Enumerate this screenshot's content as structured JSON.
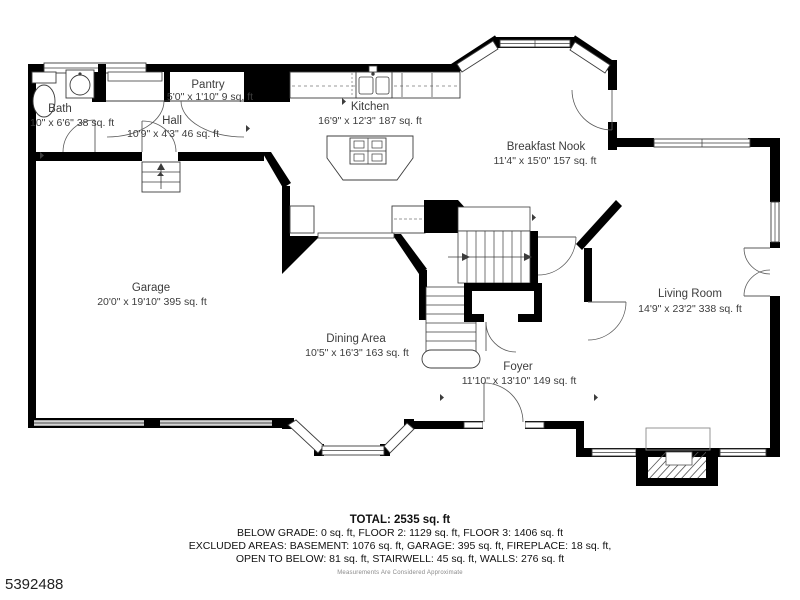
{
  "plan": {
    "rooms": {
      "bath": {
        "name": "Bath",
        "dims": "10\" x 6'6\" 38 sq. ft"
      },
      "pantry": {
        "name": "Pantry",
        "dims": "5'0\" x 1'10\" 9 sq. ft"
      },
      "hall": {
        "name": "Hall",
        "dims": "10'9\" x 4'3\" 46 sq. ft"
      },
      "kitchen": {
        "name": "Kitchen",
        "dims": "16'9\" x 12'3\" 187 sq. ft"
      },
      "breakfast_nook": {
        "name": "Breakfast Nook",
        "dims": "11'4\" x 15'0\" 157 sq. ft"
      },
      "garage": {
        "name": "Garage",
        "dims": "20'0\" x 19'10\" 395 sq. ft"
      },
      "dining": {
        "name": "Dining Area",
        "dims": "10'5\" x 16'3\" 163 sq. ft"
      },
      "foyer": {
        "name": "Foyer",
        "dims": "11'10\" x 13'10\" 149 sq. ft"
      },
      "living": {
        "name": "Living Room",
        "dims": "14'9\" x 23'2\" 338 sq. ft"
      }
    }
  },
  "summary": {
    "total": "TOTAL: 2535 sq. ft",
    "line2": "BELOW GRADE: 0 sq. ft, FLOOR 2: 1129 sq. ft, FLOOR 3: 1406 sq. ft",
    "line3": "EXCLUDED AREAS: BASEMENT: 1076 sq. ft, GARAGE: 395 sq. ft, FIREPLACE: 18 sq. ft,",
    "line4": "OPEN TO BELOW: 81 sq. ft, STAIRWELL: 45 sq. ft, WALLS: 276 sq. ft",
    "disclaimer": "Measurements Are Considered Approximate"
  },
  "listing_id": "5392488",
  "colors": {
    "wall": "#000000",
    "line": "#3c3c3c",
    "text": "#3d3d3d",
    "garage_door": "#8f8f8f"
  }
}
